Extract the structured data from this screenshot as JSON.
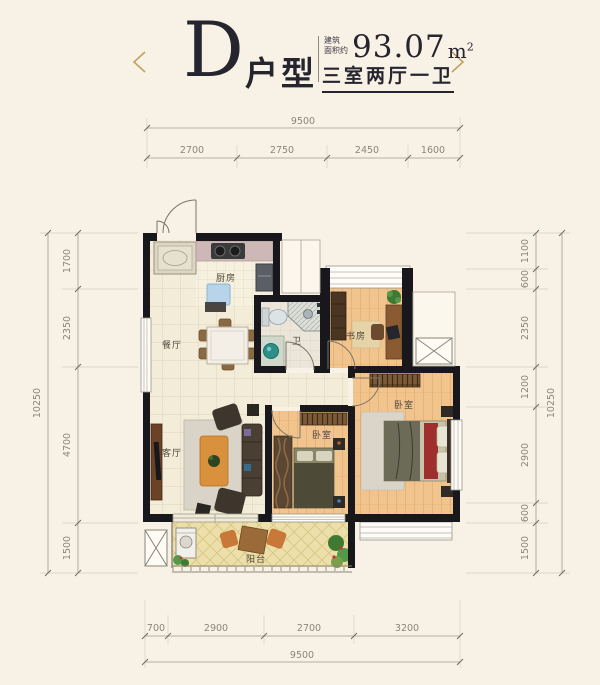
{
  "header": {
    "unit_letter": "D",
    "unit_type_label": "户型",
    "area_prefix_line1": "建筑",
    "area_prefix_line2": "面积约",
    "area_value": "93.07",
    "area_unit_base": "m",
    "area_unit_exponent": "2",
    "layout_summary": "三室两厅一卫"
  },
  "rooms": {
    "dining": "餐厅",
    "kitchen": "厨房",
    "bathroom": "卫",
    "study": "书房",
    "bedroom_master": "卧室",
    "bedroom_second": "卧室",
    "living": "客厅",
    "balcony": "阳台"
  },
  "dimensions": {
    "top": {
      "total": "9500",
      "segments": [
        "2700",
        "2750",
        "2450",
        "1600"
      ]
    },
    "bottom": {
      "total": "9500",
      "segments": [
        "700",
        "2900",
        "2700",
        "3200"
      ]
    },
    "left": {
      "total": "10250",
      "segments": [
        "1700",
        "2350",
        "4700",
        "1500"
      ]
    },
    "right": {
      "total": "10250",
      "segments": [
        "1100",
        "600",
        "2350",
        "1200",
        "2900",
        "600",
        "1500"
      ]
    }
  },
  "colors": {
    "accent_gold": "#bfa35c",
    "title_ink": "#26242e",
    "wall": "#17171c",
    "dimension_text": "#8b857a",
    "background": "#f8f2e6"
  }
}
